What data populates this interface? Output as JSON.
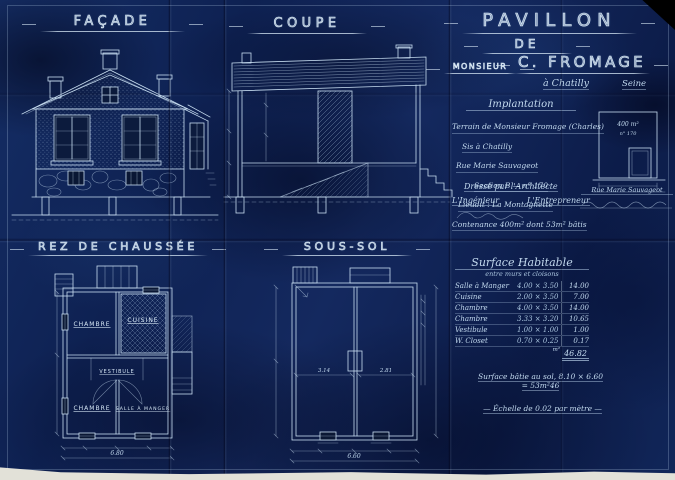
{
  "sheet": {
    "bg_primary": "#11265c",
    "line_color": "#cfe3f4"
  },
  "labels": {
    "facade": "FAÇADE",
    "coupe": "COUPE",
    "rdc": "REZ DE CHAUSSÉE",
    "soussol": "SOUS-SOL"
  },
  "title_block": {
    "line1": "PAVILLON",
    "line2": "DE",
    "line3": "MONSIEUR",
    "line4": "C. FROMAGE",
    "location": "à Chatilly",
    "department": "Seine"
  },
  "implantation": {
    "title": "Implantation",
    "lines": [
      "Terrain de Monsieur Fromage (Charles)",
      "Sis à Chatilly",
      "Rue Marie Sauvageot",
      "Section B — n° 170",
      "Lieudit : La Montagnette",
      "Contenance 400m² dont 53m² bâtis"
    ]
  },
  "site_plan": {
    "area": "400 m²",
    "parcel": "n° 170",
    "street": "Rue Marie Sauvageot"
  },
  "signatures": {
    "architect": "Dressé par l'Architecte",
    "engineer": "L'Ingénieur",
    "contractor": "L'Entrepreneur"
  },
  "surface_table": {
    "title": "Surface Habitable",
    "subtitle": "entre murs et cloisons",
    "rows": [
      {
        "name": "Salle à Manger",
        "dims": "4.00 × 3.50",
        "area": "14.00"
      },
      {
        "name": "Cuisine",
        "dims": "2.00 × 3.50",
        "area": "7.00"
      },
      {
        "name": "Chambre",
        "dims": "4.00 × 3.50",
        "area": "14.00"
      },
      {
        "name": "Chambre",
        "dims": "3.33 × 3.20",
        "area": "10.65"
      },
      {
        "name": "Vestibule",
        "dims": "1.00 × 1.00",
        "area": "1.00"
      },
      {
        "name": "W. Closet",
        "dims": "0.70 × 0.25",
        "area": "0.17"
      }
    ],
    "total_unit": "m²",
    "total": "46.82"
  },
  "notes": {
    "built_area_1": "Surface bâtie au sol, 8.10 × 6.60",
    "built_area_2": "= 53m²46",
    "scale": "— Échelle de 0.02 par mètre —"
  },
  "rdc_plan": {
    "rooms": [
      "CHAMBRE",
      "CUISINE",
      "VESTIBULE",
      "CHAMBRE",
      "SALLE À MANGER"
    ],
    "dim_overall": "6.80"
  },
  "soussol_plan": {
    "dim_overall": "6.60",
    "dim_left": "3.14",
    "dim_right": "2.81"
  }
}
